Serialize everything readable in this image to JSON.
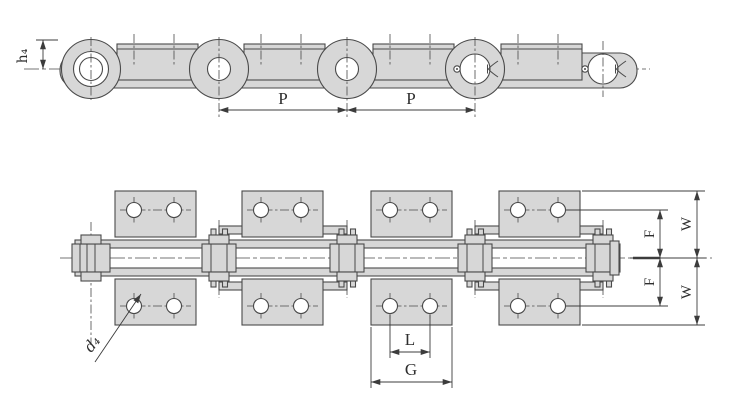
{
  "colors": {
    "part_fill": "#d7d7d7",
    "line": "#4a4a4a",
    "dim_line": "#3c3c3c",
    "text": "#2e2e2e",
    "background": "#ffffff"
  },
  "side_view": {
    "dim_h4": "h₄",
    "dim_pitch_1": "P",
    "dim_pitch_2": "P"
  },
  "plan_view": {
    "dim_d4": "d₄",
    "dim_L": "L",
    "dim_G": "G",
    "dim_F_upper": "F",
    "dim_F_lower": "F",
    "dim_W_upper": "W",
    "dim_W_lower": "W"
  }
}
